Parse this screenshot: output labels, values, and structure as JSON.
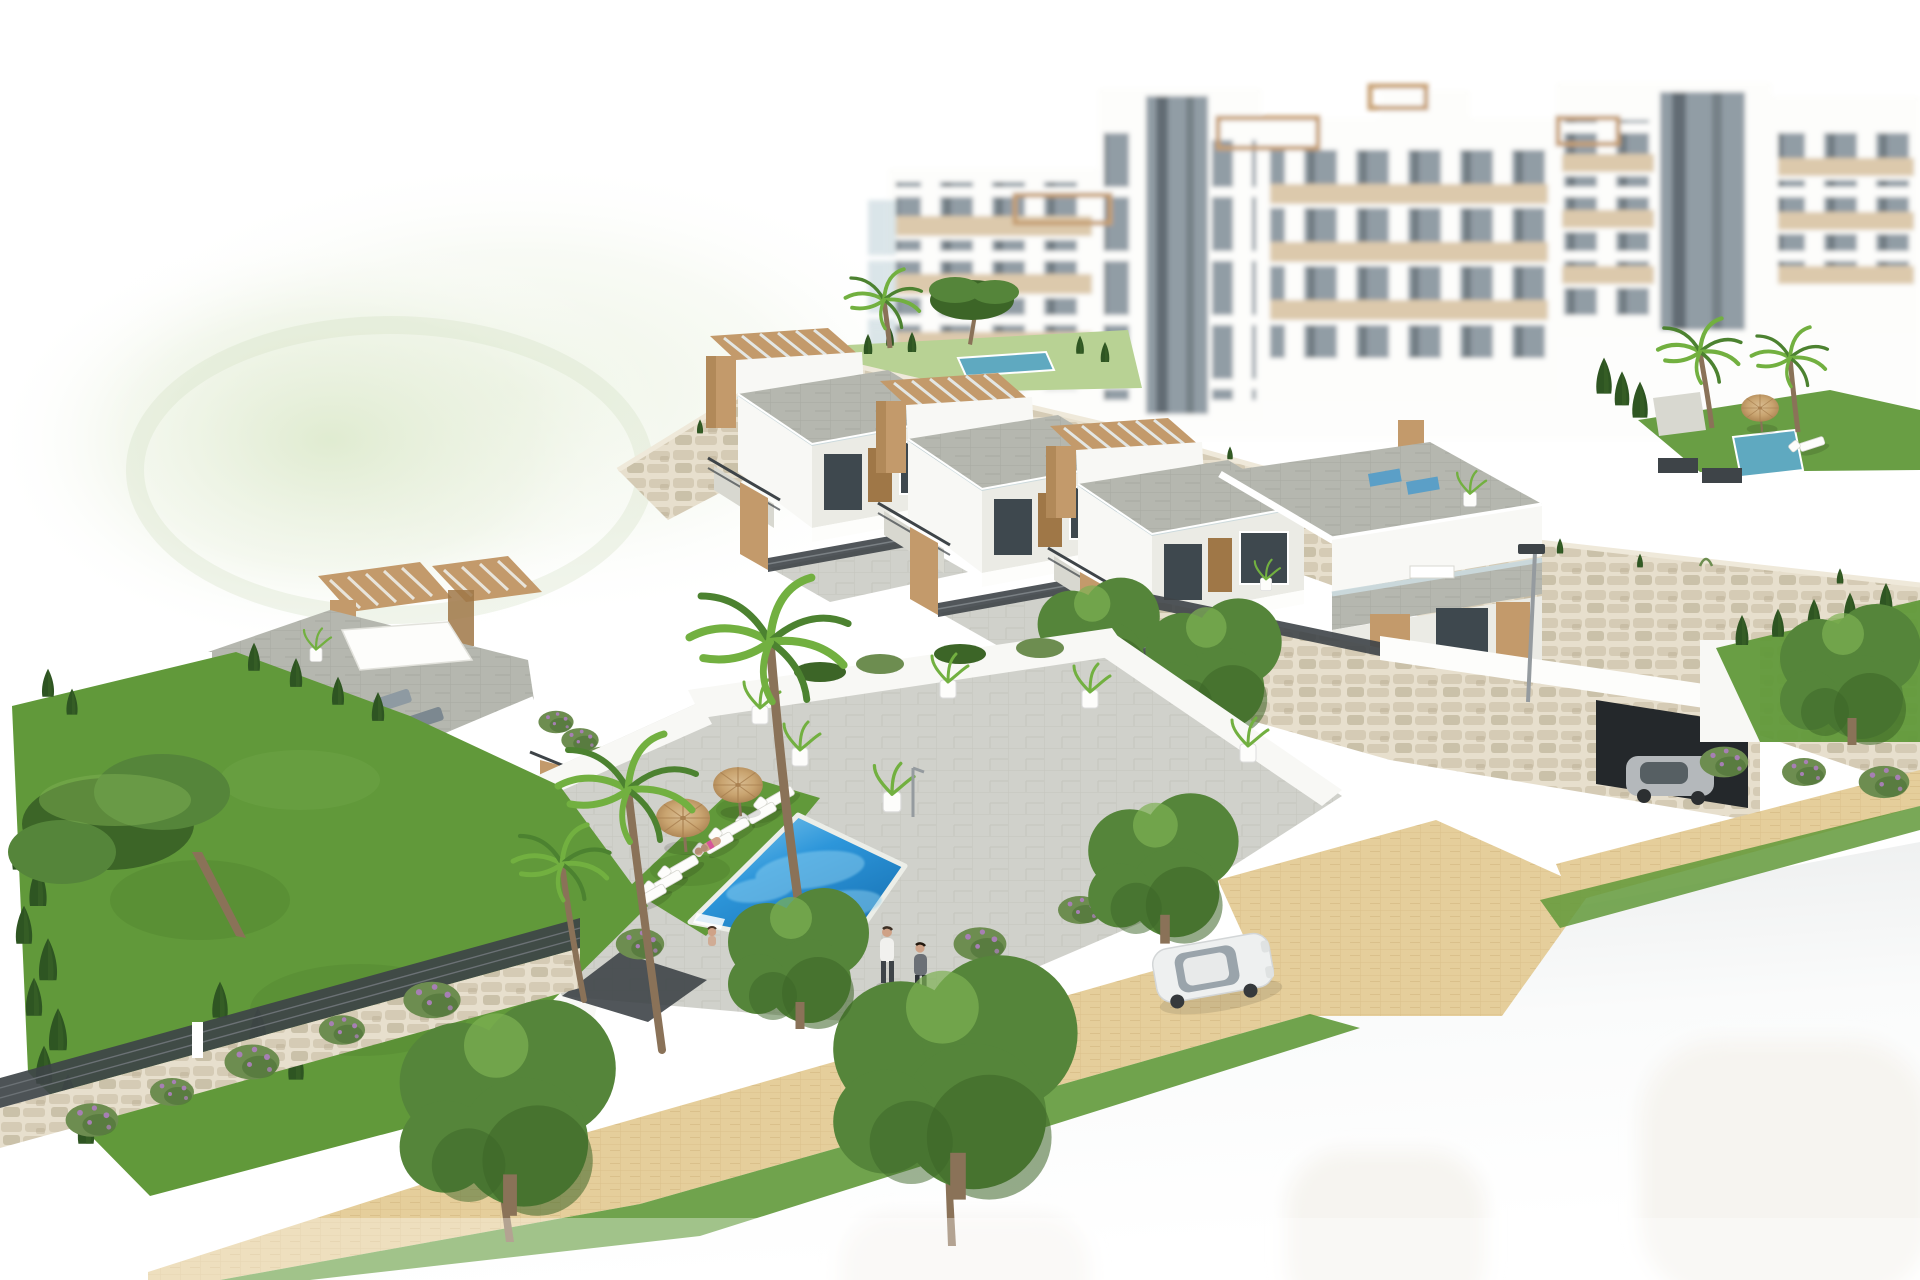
{
  "meta": {
    "width_px": 1920,
    "height_px": 1280,
    "kind": "architectural-3d-render",
    "visible_text": "none"
  },
  "scene": {
    "description": "Aerial 3D architectural rendering of a modern white Mediterranean hillside residential development: a row of terraced townhouses with wooden pergola roof terraces and external staircases, a left duplex villa block, a communal blue swimming pool with white sun loungers and two straw parasols on a lawn, landscaped gardens with palms, a stone pine and cypress hedges, natural-stone retaining walls, hazy white apartment blocks in the background, a sandy paved promenade with two pedestrians, a white sedan on a light grey road that fades to white, a garage with a grey car, a street lamp and a tiny blue flag.",
    "lighting": "bright daylight, high-key, edges fade to white",
    "colors": {
      "canvas_white": "#ffffff",
      "haze_green": "#dce9cb",
      "haze_green_soft": "#edf3e4",
      "road_grey": "#e7e9e9",
      "road_fade": "#fafbfb",
      "ghost_white": "#f6f4f0",
      "path_sand": "#e5ce9b",
      "path_sand_dark": "#cdb079",
      "pavement_grey": "#d0d1cb",
      "pavement_line": "#b9bab2",
      "terrace_grey": "#b5b7af",
      "terrace_dark": "#999c93",
      "wall_white": "#f8f8f5",
      "wall_bright": "#fdfdfb",
      "wall_shade": "#ebebe5",
      "wall_shadow": "#d8d8d0",
      "wood_tan": "#c39a6b",
      "wood_dark": "#9f7747",
      "wood_light": "#d9bd92",
      "glass_dark": "#3e484e",
      "frame_dark": "#2c3338",
      "railing_dark": "#3e4448",
      "glass_pale": "#ccdbe0",
      "stone_beige": "#d5cbb5",
      "stone_dark": "#b3a78c",
      "stone_mortar": "#e7dfcd",
      "pool_blue": "#2d96da",
      "pool_deep": "#1670b2",
      "pool_light": "#8ed0f0",
      "plunge_teal": "#5fa9c0",
      "lawn_green": "#61993a",
      "lawn_dark": "#497728",
      "lawn_pale": "#b8d294",
      "tree_green": "#55853a",
      "tree_dark": "#3c6527",
      "tree_light": "#7db052",
      "cypress_green": "#2e5522",
      "bush_green": "#6d8d50",
      "bush_flower": "#a77fb4",
      "palm_green": "#72b040",
      "palm_dark": "#4c8230",
      "trunk_brown": "#8a7258",
      "umbrella_straw": "#c9a470",
      "umbrella_dark": "#a98050",
      "skin_tone": "#cfa287",
      "swimsuit_pink": "#d6569a",
      "car_grey": "#b4b8bb",
      "car_white": "#eef0f0",
      "car_glass": "#9aa4ab",
      "lamp_grey": "#959b9f",
      "flag_blue": "#4a7fc1",
      "beige_panel": "#dbc7a8",
      "glazing_grey": "#8c98a1",
      "glazing_dark": "#5a656d"
    },
    "objects": {
      "apartment_blocks": {
        "label": "hazy background apartment towers",
        "count": 5
      },
      "townhouse_units": {
        "label": "terraced townhouses with pergola roof terraces",
        "count": 4
      },
      "villa_block": {
        "label": "left duplex villa with roof terrace and sail canopy",
        "count": 1
      },
      "main_pool": {
        "label": "communal swimming pool",
        "shape": "rotated rectangle"
      },
      "plunge_pools": {
        "label": "small upper-terrace pools",
        "count": 2
      },
      "sun_loungers_white": {
        "label": "white sun loungers at pool",
        "count": 7
      },
      "parasols": {
        "label": "straw parasols",
        "count": 2
      },
      "sunbather": {
        "label": "person sunbathing on lounger",
        "count": 1
      },
      "swimmer": {
        "label": "person at pool steps",
        "count": 1
      },
      "pedestrians": {
        "label": "people walking on promenade",
        "count": 2
      },
      "white_car": {
        "label": "white sedan on road",
        "count": 1
      },
      "garage_car": {
        "label": "grey car at garage entrance",
        "count": 1
      },
      "ghost_cars": {
        "label": "faded unfinished car silhouettes on road",
        "count": 3
      },
      "street_lamp": {
        "label": "street lamp by driveway",
        "count": 1
      },
      "flag": {
        "label": "tiny blue flag",
        "count": 1
      },
      "stone_walls": {
        "label": "natural stone retaining walls"
      },
      "promenade": {
        "label": "sand-coloured paved footpath"
      },
      "road": {
        "label": "light grey road fading to white"
      },
      "vegetation": {
        "label": "palms, stone pine, cypresses, flowering bushes, leafy trees"
      }
    }
  }
}
